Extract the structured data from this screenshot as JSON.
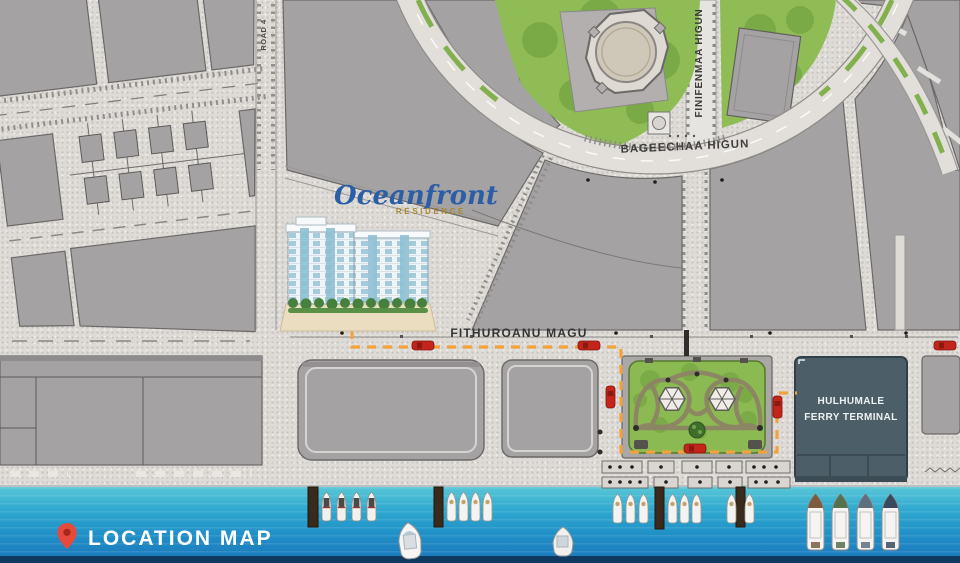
{
  "map": {
    "roads": {
      "road4": "ROAD 4",
      "finifenmaa": "FINIFENMAA HIGUN",
      "bageechaa": "BAGEECHAA HIGUN",
      "fithuroanu": "FITHUROANU MAGU"
    },
    "terminal": {
      "label": "HULHUMALE FERRY TERMINAL"
    }
  },
  "logo": {
    "name": "Oceanfront",
    "subtitle": "RESIDENCE"
  },
  "footer": {
    "label": "LOCATION MAP"
  },
  "legend_colors": {
    "route_accent": "#F2A23C",
    "water": "#2196CD",
    "terminal_fill": "#4C5E68",
    "block_fill": "#A5A2A3",
    "park_green": "#8CBA52",
    "car_red": "#C3251B",
    "pin_red": "#E64A3C",
    "logo_blue": "#2B5EA7",
    "logo_gold": "#A8872F"
  },
  "icons": {
    "location_pin": "map-pin-teardrop"
  }
}
